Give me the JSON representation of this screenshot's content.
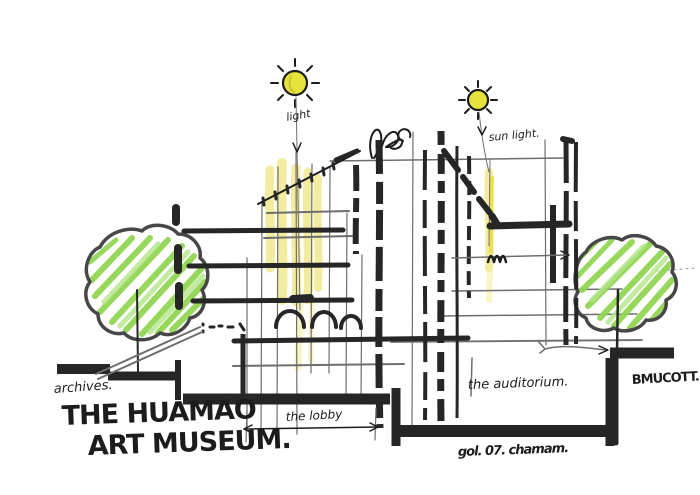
{
  "title": "Hand-drawn museum section sketch",
  "labels": {
    "sun1_note": "light",
    "sun2_note": "sun light.",
    "archives_note": "archives.",
    "title_line1": "THE HUAMAO",
    "title_line2": "ART MUSEUM.",
    "lobby_note": "the lobby",
    "auditorium_note": "the auditorium.",
    "site_note": "BMUCOTT.",
    "signature": "gol. 07. chamam."
  },
  "colors": {
    "paper": "#ffffff",
    "ink": "#1c1c1c",
    "marker": "#262626",
    "pencil": "#6e6e6e",
    "pencil2": "#9a9a9a",
    "sun": "#e5e33c",
    "sun_detail": "#c8c52a",
    "light": "#f2ec9b",
    "light_bright": "#e9df45",
    "green": "#8ed44e",
    "green_light": "#b4e58a",
    "outline": "#474747"
  }
}
